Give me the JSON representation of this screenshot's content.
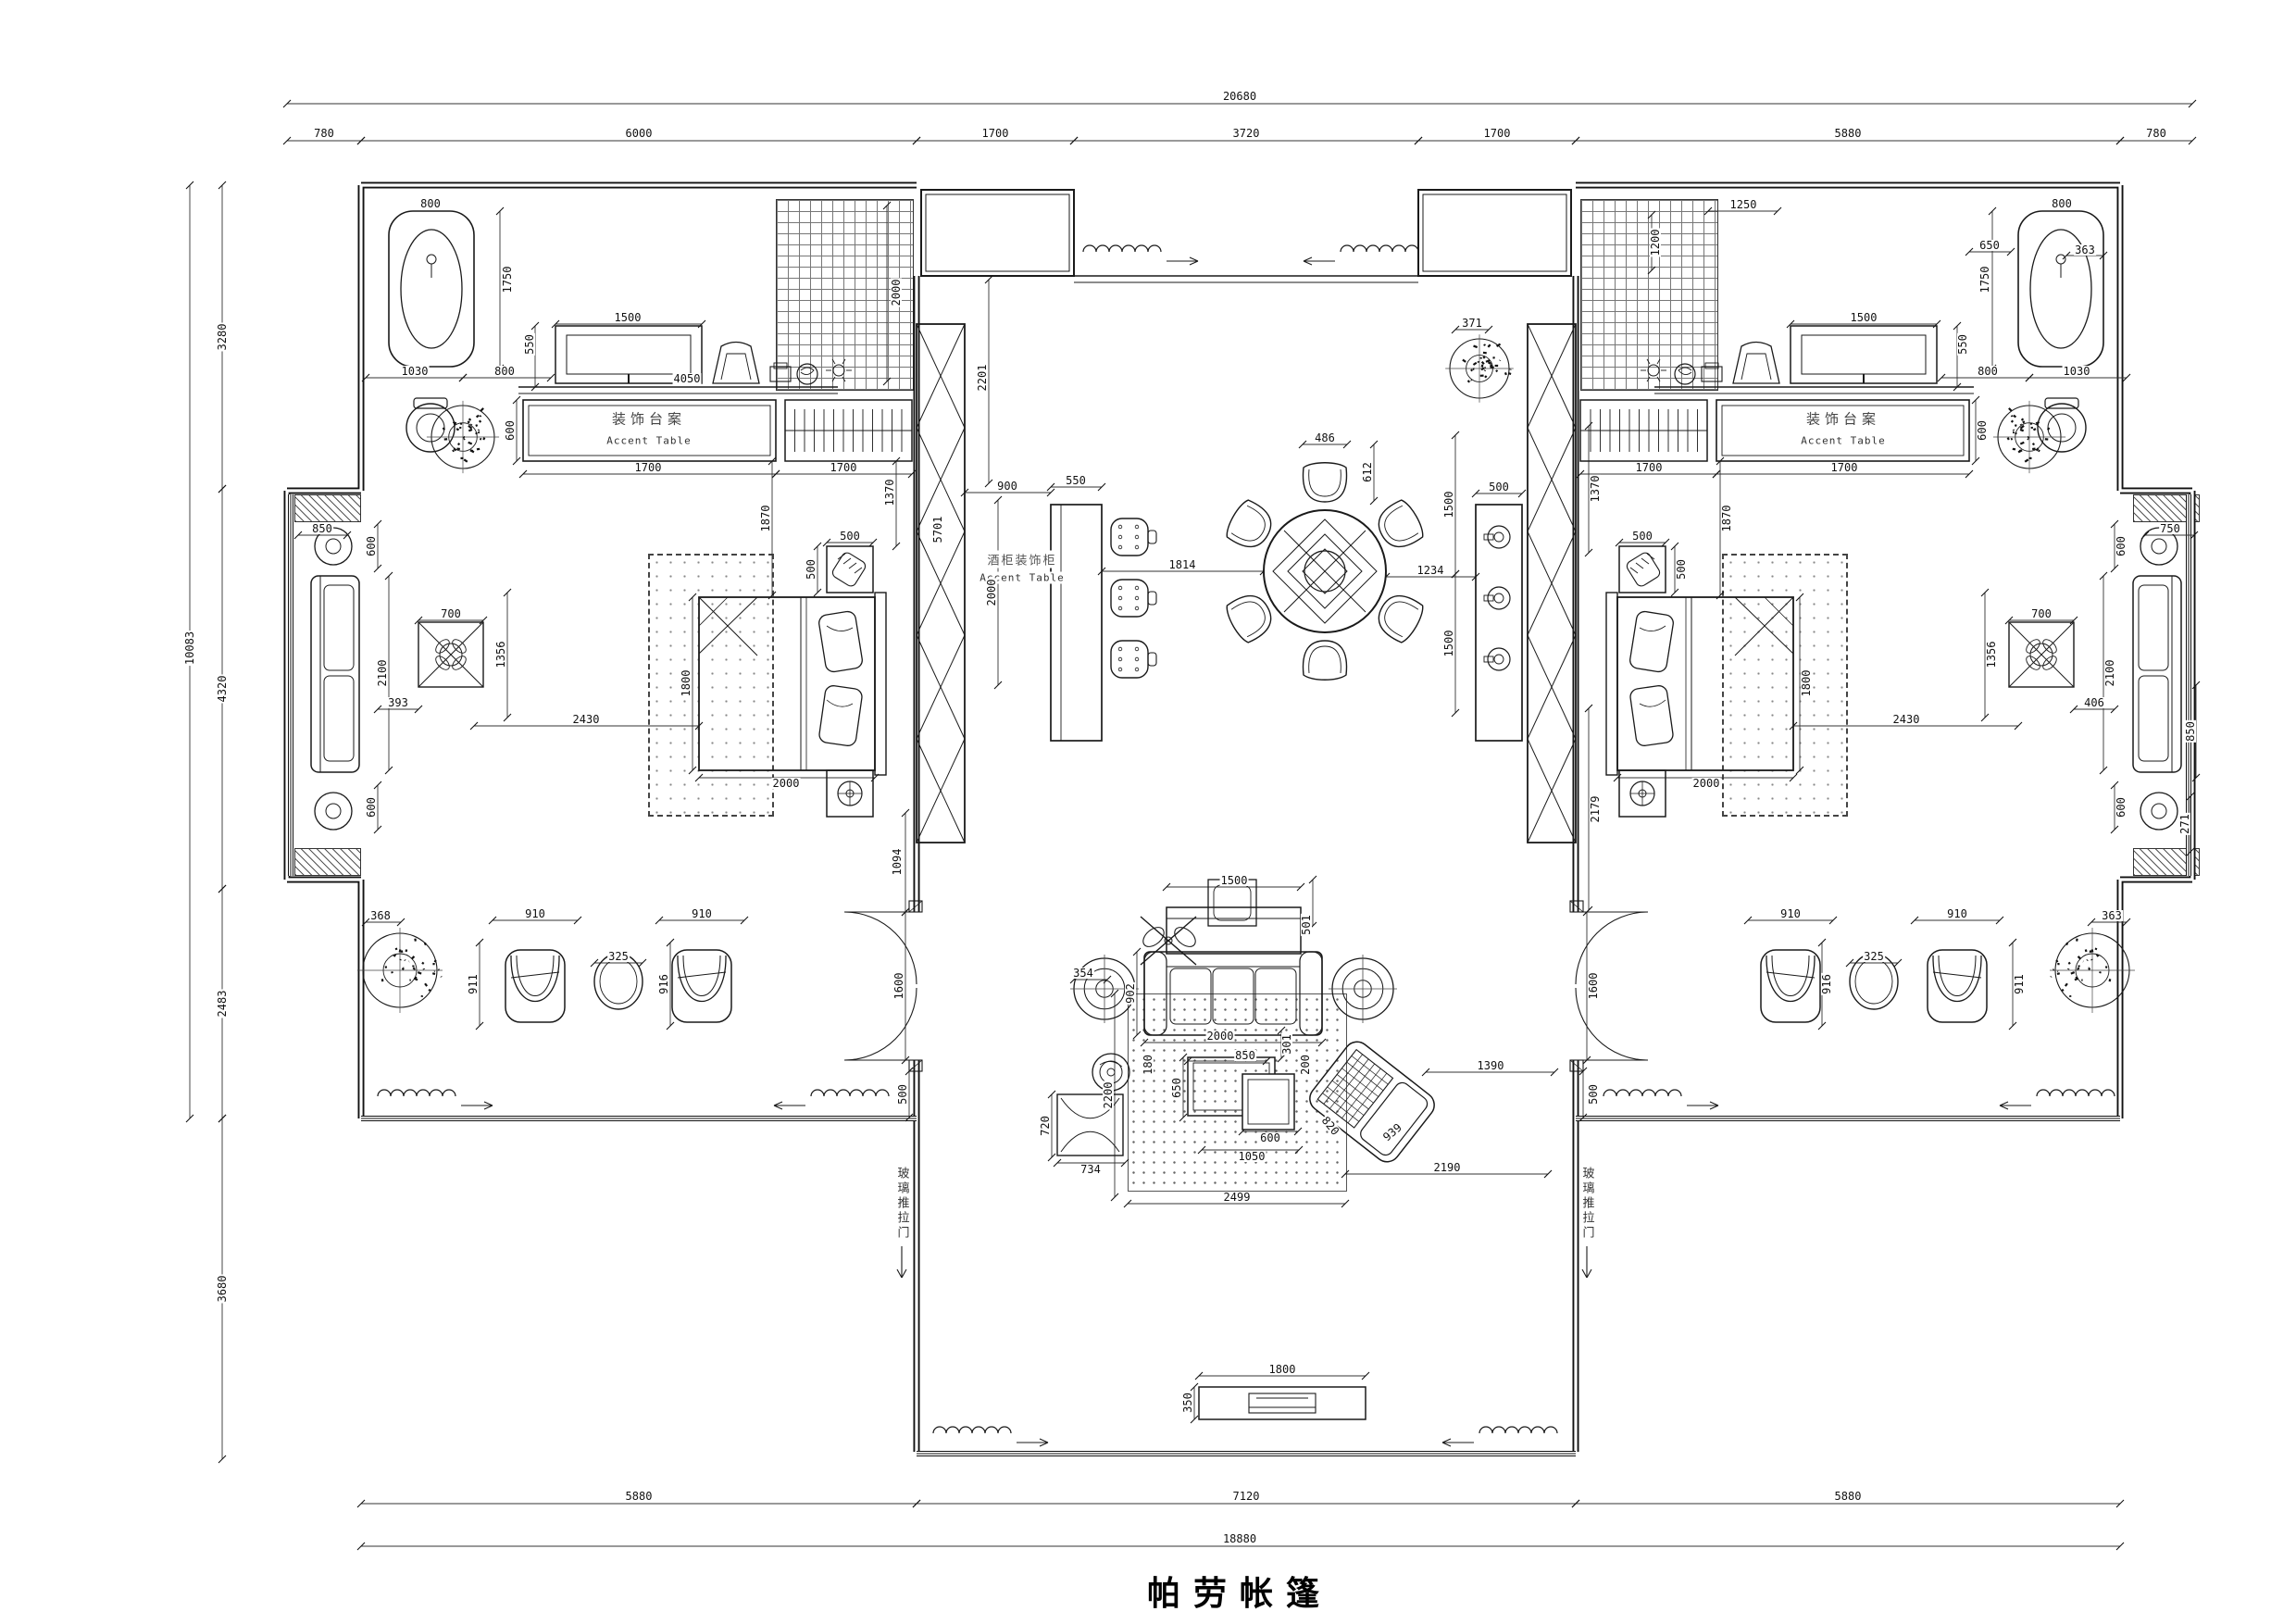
{
  "title": "帕劳帐篷",
  "drawing": {
    "type": "floor-plan",
    "units": "mm",
    "line_color": "#1a1a1a"
  },
  "dimension_chains": {
    "top": {
      "total": "20680",
      "segments": [
        "780",
        "6000",
        "1700",
        "3720",
        "1700",
        "5880",
        "780"
      ]
    },
    "left": {
      "total": "10083",
      "segments": [
        "3280",
        "4320",
        "2483",
        "3680"
      ]
    },
    "bottom": {
      "total": "18880",
      "segments": [
        "5880",
        "7120",
        "5880"
      ]
    }
  },
  "room_labels": {
    "accent_table_cn": "装饰台案",
    "accent_table_en": "Accent Table",
    "wine_cabinet_cn": "酒柜装饰柜",
    "wine_cabinet_en": "Accent Table",
    "glass_sliding_door_cn": "玻璃推拉门"
  },
  "labels": [
    [
      "20680",
      1339,
      104
    ],
    [
      "780",
      350,
      144
    ],
    [
      "6000",
      690,
      144
    ],
    [
      "1700",
      1075,
      144
    ],
    [
      "3720",
      1346,
      144
    ],
    [
      "1700",
      1617,
      144
    ],
    [
      "5880",
      1996,
      144
    ],
    [
      "780",
      2329,
      144
    ],
    [
      "10083",
      205,
      700,
      -90
    ],
    [
      "3280",
      240,
      364,
      -90
    ],
    [
      "4320",
      240,
      744,
      -90
    ],
    [
      "2483",
      240,
      1084,
      -90
    ],
    [
      "3680",
      240,
      1392,
      -90
    ],
    [
      "5880",
      690,
      1616
    ],
    [
      "7120",
      1346,
      1616
    ],
    [
      "5880",
      1996,
      1616
    ],
    [
      "18880",
      1339,
      1662
    ],
    [
      "800",
      465,
      220
    ],
    [
      "1750",
      548,
      302,
      -90
    ],
    [
      "1030",
      448,
      401
    ],
    [
      "800",
      545,
      401
    ],
    [
      "1500",
      678,
      343
    ],
    [
      "4050",
      742,
      409
    ],
    [
      "550",
      572,
      372,
      -90
    ],
    [
      "2000",
      968,
      316,
      -90
    ],
    [
      "600",
      551,
      465,
      -90
    ],
    [
      "装饰台案",
      701,
      452,
      0,
      "k"
    ],
    [
      "Accent Table",
      701,
      476,
      0,
      "e"
    ],
    [
      "1700",
      700,
      505
    ],
    [
      "1700",
      911,
      505
    ],
    [
      "1870",
      827,
      560,
      -90
    ],
    [
      "1370",
      961,
      532,
      -90
    ],
    [
      "500",
      918,
      579
    ],
    [
      "500",
      876,
      615,
      -90
    ],
    [
      "1800",
      741,
      738,
      -90
    ],
    [
      "2000",
      849,
      846
    ],
    [
      "2430",
      633,
      777
    ],
    [
      "850",
      348,
      571
    ],
    [
      "600",
      401,
      590,
      -90
    ],
    [
      "600",
      401,
      872,
      -90
    ],
    [
      "2100",
      413,
      727,
      -90
    ],
    [
      "393",
      430,
      759
    ],
    [
      "700",
      487,
      663
    ],
    [
      "1356",
      541,
      707,
      -90
    ],
    [
      "1600",
      971,
      1065,
      -90
    ],
    [
      "1094",
      969,
      931,
      -90
    ],
    [
      "500",
      975,
      1182,
      -90
    ],
    [
      "368",
      411,
      989
    ],
    [
      "910",
      578,
      987
    ],
    [
      "911",
      511,
      1063,
      -90
    ],
    [
      "325",
      668,
      1033
    ],
    [
      "910",
      758,
      987
    ],
    [
      "916",
      717,
      1063,
      -90
    ],
    [
      "2201",
      1061,
      408,
      -90
    ],
    [
      "900",
      1088,
      525
    ],
    [
      "550",
      1162,
      519
    ],
    [
      "5701",
      1013,
      572,
      -90
    ],
    [
      "酒柜装饰柜",
      1104,
      604,
      0,
      "k2"
    ],
    [
      "Accent Table",
      1104,
      624,
      0,
      "e"
    ],
    [
      "2000",
      1071,
      640,
      -90
    ],
    [
      "1814",
      1277,
      610
    ],
    [
      "486",
      1431,
      473
    ],
    [
      "612",
      1477,
      510,
      -90
    ],
    [
      "1234",
      1545,
      616
    ],
    [
      "1500",
      1565,
      545,
      -90
    ],
    [
      "1500",
      1565,
      695,
      -90
    ],
    [
      "500",
      1619,
      526
    ],
    [
      "371",
      1590,
      349
    ],
    [
      "1370",
      1723,
      528,
      -90
    ],
    [
      "2179",
      1723,
      874,
      -90
    ],
    [
      "1600",
      1721,
      1065,
      -90
    ],
    [
      "500",
      1721,
      1182,
      -90
    ],
    [
      "1500",
      1333,
      951
    ],
    [
      "501",
      1411,
      999,
      -90
    ],
    [
      "902",
      1221,
      1073,
      -90
    ],
    [
      "354",
      1170,
      1051
    ],
    [
      "2000",
      1318,
      1119
    ],
    [
      "301",
      1390,
      1128,
      -90
    ],
    [
      "850",
      1345,
      1140
    ],
    [
      "650",
      1271,
      1175,
      -90
    ],
    [
      "180",
      1240,
      1150,
      -90
    ],
    [
      "200",
      1410,
      1150,
      -90
    ],
    [
      "600",
      1372,
      1229
    ],
    [
      "1050",
      1352,
      1249
    ],
    [
      "2200",
      1197,
      1183,
      -90
    ],
    [
      "2499",
      1336,
      1293
    ],
    [
      "820",
      1437,
      1216,
      50
    ],
    [
      "939",
      1504,
      1223,
      -40
    ],
    [
      "734",
      1178,
      1263
    ],
    [
      "720",
      1129,
      1216,
      -90
    ],
    [
      "2190",
      1563,
      1261
    ],
    [
      "1390",
      1610,
      1151
    ],
    [
      "1800",
      1385,
      1479
    ],
    [
      "350",
      1283,
      1515,
      -90
    ],
    [
      "玻璃推拉门",
      974,
      1300,
      0,
      "kv"
    ],
    [
      "玻璃推拉门",
      1714,
      1300,
      0,
      "kv"
    ],
    [
      "800",
      2227,
      220
    ],
    [
      "1750",
      2144,
      302,
      -90
    ],
    [
      "1030",
      2243,
      401
    ],
    [
      "800",
      2147,
      401
    ],
    [
      "1500",
      2013,
      343
    ],
    [
      "1250",
      1883,
      221
    ],
    [
      "1200",
      1788,
      262,
      -90
    ],
    [
      "650",
      2149,
      265
    ],
    [
      "550",
      2120,
      372,
      -90
    ],
    [
      "600",
      2141,
      465,
      -90
    ],
    [
      "装饰台案",
      1991,
      452,
      0,
      "k"
    ],
    [
      "Accent Table",
      1991,
      476,
      0,
      "e"
    ],
    [
      "1700",
      1992,
      505
    ],
    [
      "1700",
      1781,
      505
    ],
    [
      "363",
      2252,
      270
    ],
    [
      "1870",
      1865,
      560,
      -90
    ],
    [
      "500",
      1774,
      579
    ],
    [
      "500",
      1816,
      615,
      -90
    ],
    [
      "2000",
      1843,
      846
    ],
    [
      "1800",
      1951,
      738,
      -90
    ],
    [
      "2430",
      2059,
      777
    ],
    [
      "750",
      2344,
      571
    ],
    [
      "600",
      2291,
      590,
      -90
    ],
    [
      "600",
      2291,
      872,
      -90
    ],
    [
      "2100",
      2279,
      727,
      -90
    ],
    [
      "406",
      2262,
      759
    ],
    [
      "700",
      2205,
      663
    ],
    [
      "1356",
      2151,
      707,
      -90
    ],
    [
      "850",
      2366,
      790,
      -90
    ],
    [
      "271",
      2360,
      890,
      -90
    ],
    [
      "363",
      2281,
      989
    ],
    [
      "910",
      2114,
      987
    ],
    [
      "911",
      2181,
      1063,
      -90
    ],
    [
      "325",
      2024,
      1033
    ],
    [
      "910",
      1934,
      987
    ],
    [
      "916",
      1973,
      1063,
      -90
    ]
  ]
}
